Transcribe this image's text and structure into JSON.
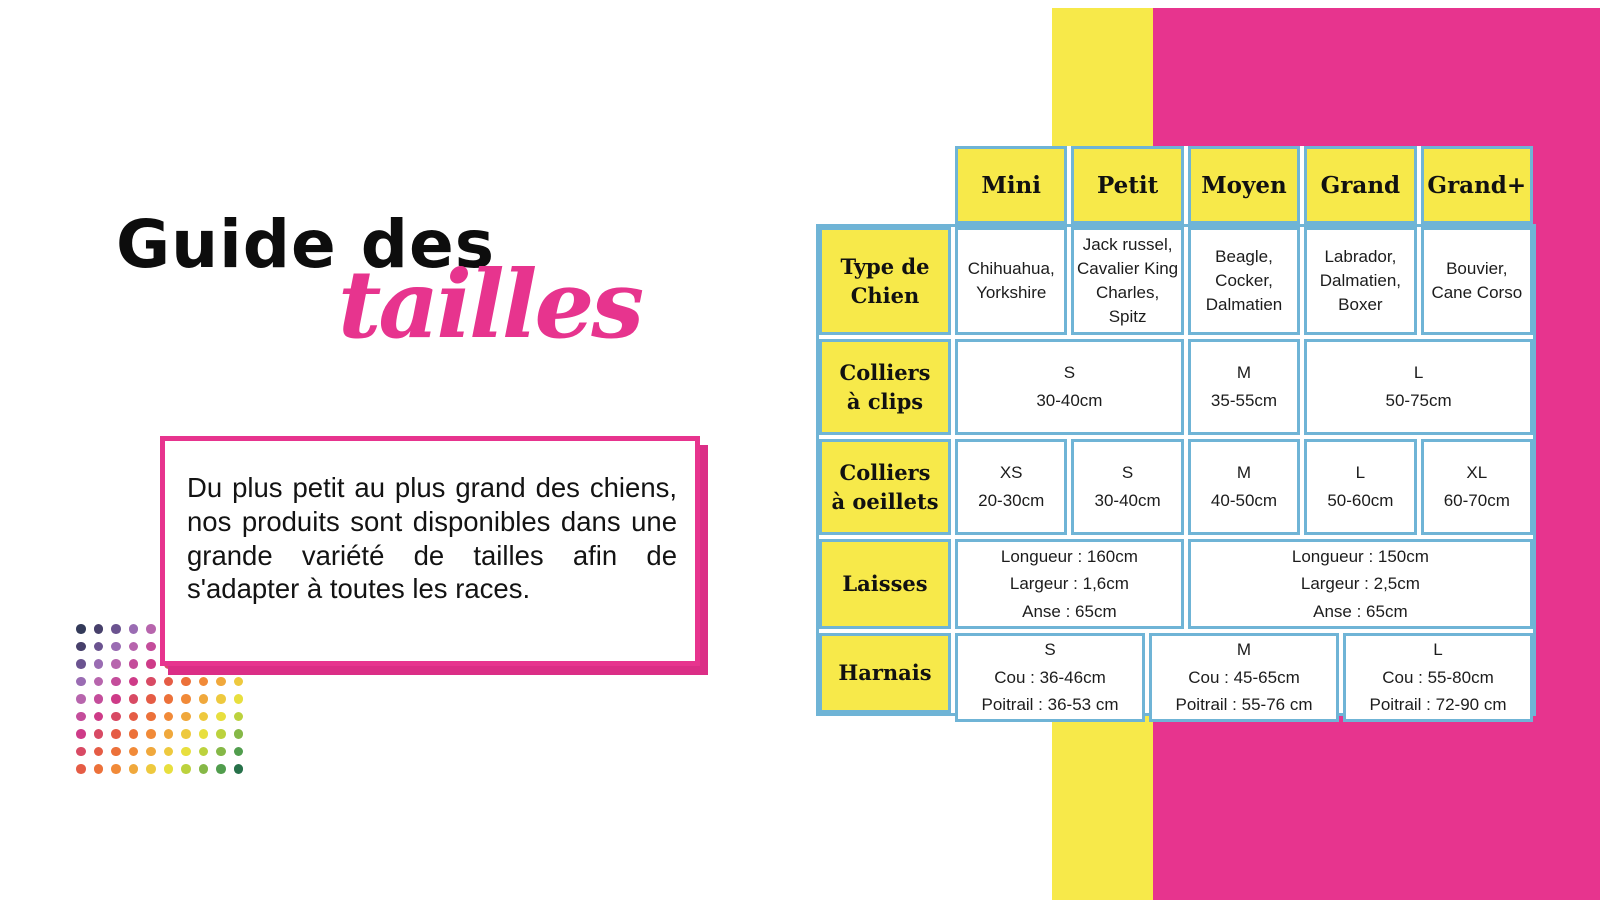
{
  "title": {
    "black": "Guide des",
    "pink": "tailles"
  },
  "intro": {
    "text": "Du plus petit au plus grand des chiens, nos produits sont disponibles dans une grande variété de tailles afin de s'adapter à toutes les races."
  },
  "colors": {
    "pink": "#e7348e",
    "yellow": "#f7e94a",
    "table_border": "#6fb4d6",
    "text_dark": "#131313"
  },
  "size_table": {
    "columns": [
      "Mini",
      "Petit",
      "Moyen",
      "Grand",
      "Grand+"
    ],
    "rows": [
      {
        "label_lines": [
          "Type de",
          "Chien"
        ],
        "cells": [
          {
            "lines": [
              "Chihuahua,",
              "Yorkshire"
            ],
            "span": 1
          },
          {
            "lines": [
              "Jack russel,",
              "Cavalier King",
              "Charles,",
              "Spitz"
            ],
            "span": 1
          },
          {
            "lines": [
              "Beagle,",
              "Cocker,",
              "Dalmatien"
            ],
            "span": 1
          },
          {
            "lines": [
              "Labrador,",
              "Dalmatien,",
              "Boxer"
            ],
            "span": 1
          },
          {
            "lines": [
              "Bouvier,",
              "Cane Corso"
            ],
            "span": 1
          }
        ]
      },
      {
        "label_lines": [
          "Colliers",
          "à clips"
        ],
        "cells": [
          {
            "lines": [
              "S",
              "30-40cm"
            ],
            "span": 2
          },
          {
            "lines": [
              "M",
              "35-55cm"
            ],
            "span": 1
          },
          {
            "lines": [
              "L",
              "50-75cm"
            ],
            "span": 2
          }
        ]
      },
      {
        "label_lines": [
          "Colliers",
          "à oeillets"
        ],
        "cells": [
          {
            "lines": [
              "XS",
              "20-30cm"
            ],
            "span": 1
          },
          {
            "lines": [
              "S",
              "30-40cm"
            ],
            "span": 1
          },
          {
            "lines": [
              "M",
              "40-50cm"
            ],
            "span": 1
          },
          {
            "lines": [
              "L",
              "50-60cm"
            ],
            "span": 1
          },
          {
            "lines": [
              "XL",
              "60-70cm"
            ],
            "span": 1
          }
        ]
      },
      {
        "label_lines": [
          "Laisses"
        ],
        "cells": [
          {
            "lines": [
              "Longueur : 160cm",
              "Largeur : 1,6cm",
              "Anse : 65cm"
            ],
            "span": 2
          },
          {
            "lines": [
              "Longueur : 150cm",
              "Largeur : 2,5cm",
              "Anse : 65cm"
            ],
            "span": 3
          }
        ]
      },
      {
        "label_lines": [
          "Harnais"
        ],
        "cells": [
          {
            "lines": [
              "S",
              "Cou : 36-46cm",
              "Poitrail : 36-53 cm"
            ],
            "span": 1
          },
          {
            "lines": [
              "M",
              "Cou : 45-65cm",
              "Poitrail : 55-76 cm"
            ],
            "span": 1
          },
          {
            "lines": [
              "L",
              "Cou : 55-80cm",
              "Poitrail : 72-90 cm"
            ],
            "span": 1
          }
        ]
      }
    ]
  },
  "decorative_dots": {
    "rows": 9,
    "cols": 10,
    "palette": [
      "#333a59",
      "#47406b",
      "#6b5390",
      "#9a6cb3",
      "#b765ad",
      "#c44d9b",
      "#ce3b88",
      "#d84a64",
      "#e55c45",
      "#ec713a",
      "#f18a38",
      "#f0a83c",
      "#eec93e",
      "#e8df3e",
      "#bcd23d",
      "#86b847",
      "#519d4d",
      "#27714a"
    ]
  }
}
